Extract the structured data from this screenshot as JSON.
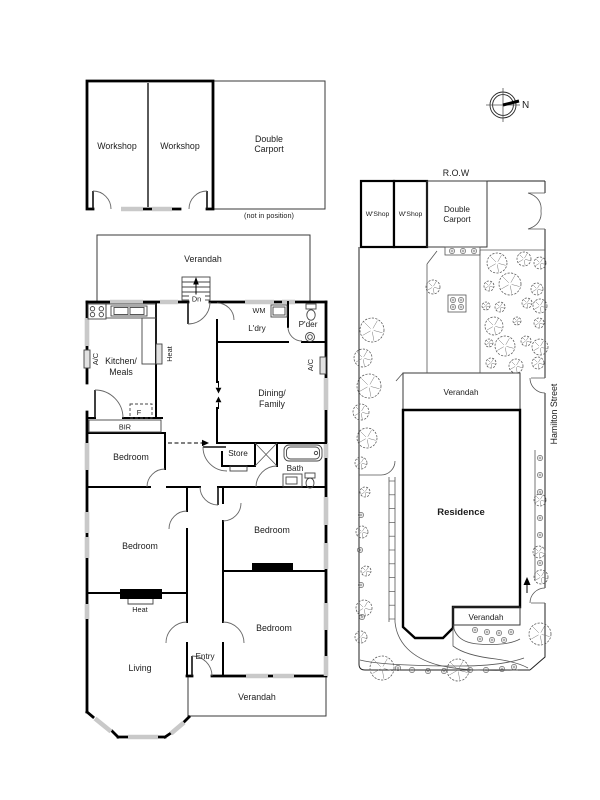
{
  "colors": {
    "ink": "#1a1a1a",
    "wall": "#000000",
    "window_gray": "#c9c9c9",
    "paper": "#ffffff"
  },
  "outbuilding_plan": {
    "workshop_left_label": "Workshop",
    "workshop_right_label": "Workshop",
    "carport_label_line1": "Double",
    "carport_label_line2": "Carport",
    "position_note": "(not in position)"
  },
  "compass": {
    "north_label": "N"
  },
  "floor_plan": {
    "verandah_back_label": "Verandah",
    "stairs_label": "Dn",
    "kitchen_label_line1": "Kitchen/",
    "kitchen_label_line2": "Meals",
    "heat_kitchen_label": "Heat",
    "ac_left_label": "A/C",
    "laundry_label": "L'dry",
    "wm_label": "WM",
    "powder_label": "P'der",
    "ac_right_label": "A/C",
    "dining_label_line1": "Dining/",
    "dining_label_line2": "Family",
    "fridge_label": "F",
    "bir_label": "BIR",
    "bedroom1_label": "Bedroom",
    "store_label": "Store",
    "bath_label": "Bath",
    "bedroom2_label": "Bedroom",
    "bedroom3_label": "Bedroom",
    "heat_living_label": "Heat",
    "bedroom4_label": "Bedroom",
    "living_label": "Living",
    "entry_label": "Entry",
    "verandah_front_label": "Verandah"
  },
  "site_plan": {
    "row_label": "R.O.W",
    "wshop_left_label": "W'Shop",
    "wshop_right_label": "W'Shop",
    "carport_label_line1": "Double",
    "carport_label_line2": "Carport",
    "verandah_back_label": "Verandah",
    "residence_label": "Residence",
    "verandah_front_label": "Verandah",
    "street_label": "Hamilton Street"
  }
}
